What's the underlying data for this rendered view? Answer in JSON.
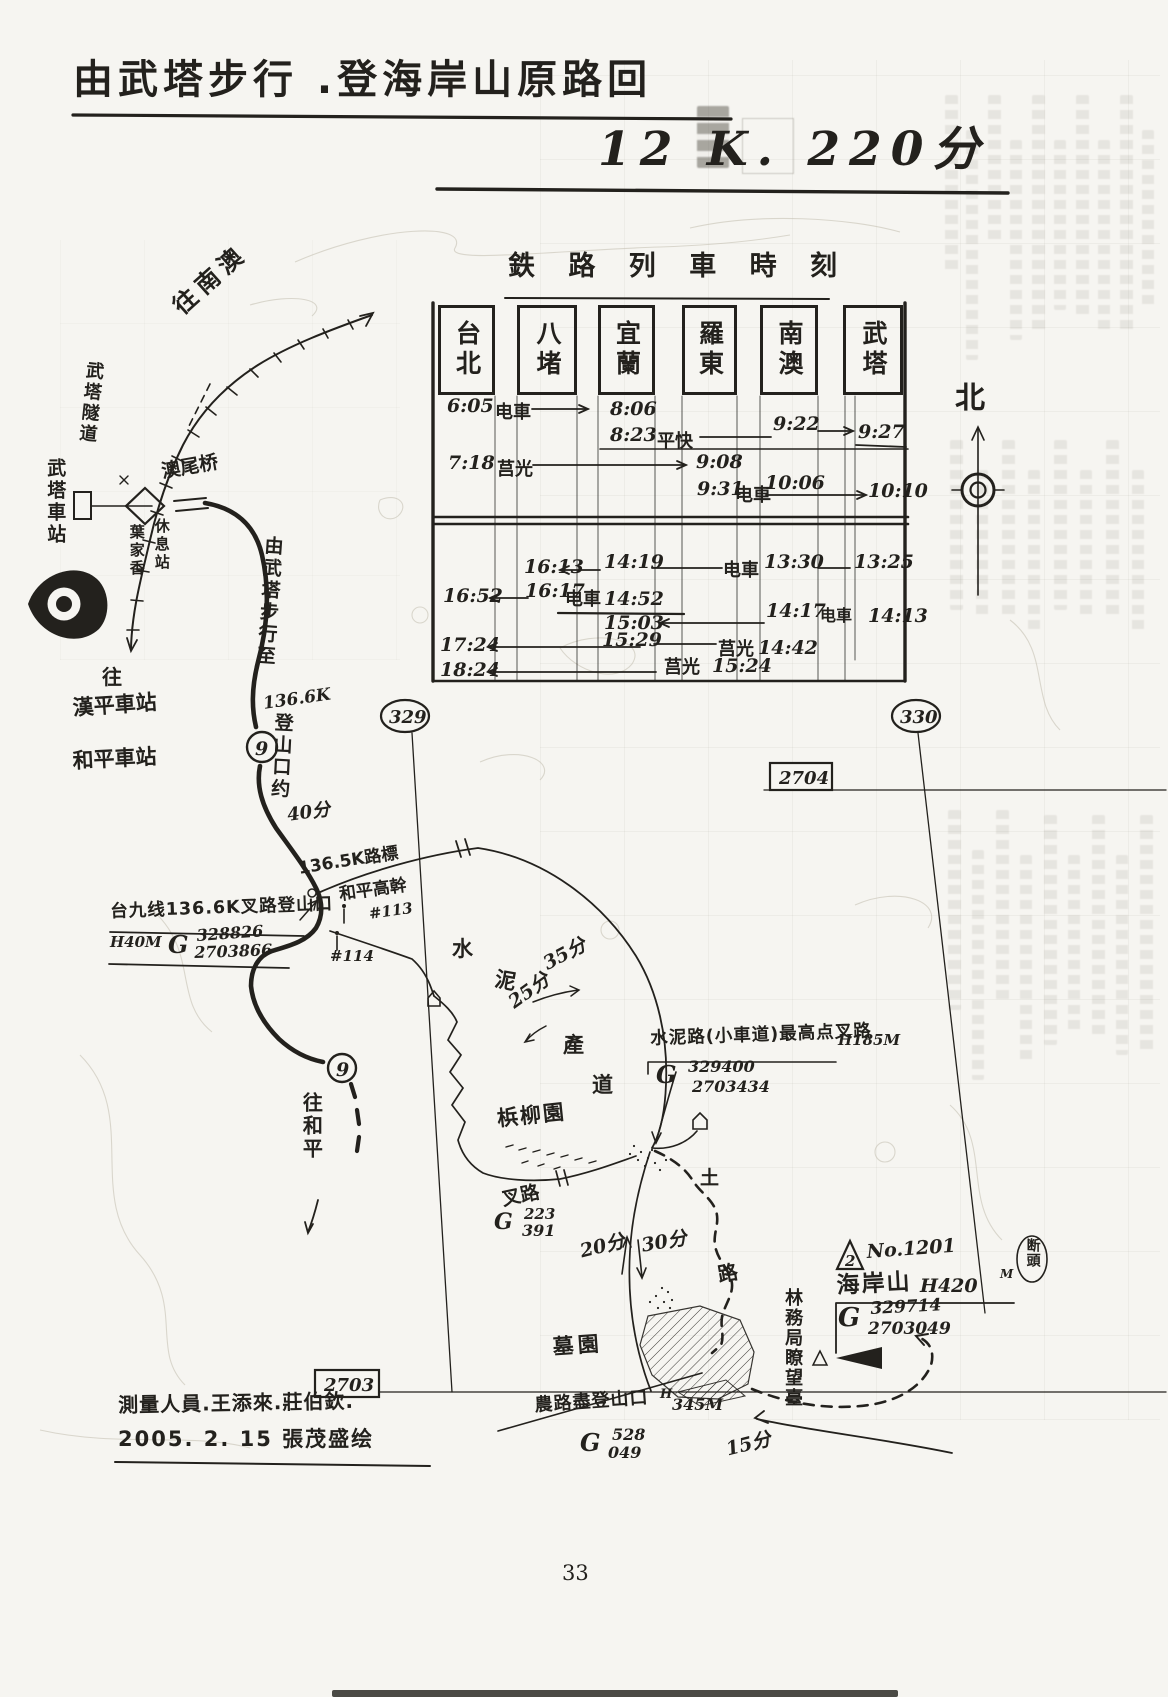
{
  "colors": {
    "ink": "#23211d",
    "paper": "#f6f5f1"
  },
  "page": {
    "number": "33"
  },
  "header": {
    "title": "由武塔步行 .登海岸山原路回",
    "subtitle_prefix": "全程约",
    "subtitle_value": "12 K. 220分"
  },
  "compass": {
    "north": "北"
  },
  "grid": {
    "v_left": "329",
    "v_right": "330",
    "h_top": "2704",
    "h_bottom": "2703"
  },
  "timetable": {
    "title": "鉄 路 列 車 時 刻",
    "stations": [
      "台北",
      "八堵",
      "宜蘭",
      "羅東",
      "南澳",
      "武塔"
    ],
    "t": {
      "r1d": "6:05",
      "r1l": "电車",
      "r1a": "8:06",
      "r2d": "8:23",
      "r2l": "平快",
      "r2a": "9:22",
      "r2b": "9:27",
      "r3d": "7:18",
      "r3l": "莒光",
      "r3a": "9:08",
      "r4d": "9:31",
      "r4l": "电車",
      "r4a": "10:06",
      "r4b": "10:10",
      "r5a": "16:13",
      "r5b": "14:19",
      "r5l": "电車",
      "r5c": "13:30",
      "r5d": "13:25",
      "r6a": "16:52",
      "r6b": "16:17",
      "r6l": "电車",
      "r6c": "14:52",
      "r7a": "15:03",
      "r7b": "14:17",
      "r7l": "电車",
      "r7c": "14:13",
      "r8a": "17:24",
      "r8b": "15:29",
      "r8l": "莒光",
      "r8c": "14:42",
      "r9a": "18:24",
      "r9l": "莒光",
      "r9b": "15:24"
    }
  },
  "map": {
    "to_nanao": "往南澳",
    "tunnel": "武塔隧道",
    "wuta_station": "武塔車站",
    "aowei_bridge": "澳尾桥",
    "rest_col_left": "葉家香",
    "rest_col_right": "休息站",
    "to_label": "往",
    "hanping_station": "漢平車站",
    "heping_station": "和平車站",
    "hwy_no": "9",
    "walk_col1": "由武塔步行至",
    "walk_k": "136.6K",
    "walk_col2": "登山口约",
    "walk_time": "40分",
    "marker_1365": "136.5K路標",
    "pole_line": "和平高幹",
    "pole_113": "#113",
    "pole_114": "#114",
    "trailhead_136": {
      "line": "台九线136.6K叉路登山口",
      "h": "H40M",
      "g": "G",
      "e": "328826",
      "n": "2703866"
    },
    "to_heping": "往和平",
    "concrete_chars": [
      "水",
      "泥",
      "產",
      "道"
    ],
    "time_35": "35分",
    "time_25": "25分",
    "highpoint": {
      "line": "水泥路(小車道)最高点叉路",
      "h": "H185M",
      "g": "G",
      "e": "329400",
      "n": "2703434"
    },
    "orchard": "梹柳園",
    "fork": {
      "label": "叉路",
      "g": "G",
      "e": "223",
      "n": "391"
    },
    "time_20": "20分",
    "time_30": "30分",
    "dirt_1": "土",
    "dirt_2": "路",
    "summit": {
      "tri_no": "2",
      "no": "No.1201",
      "badge": "断頭",
      "name": "海岸山",
      "h": "H420",
      "m": "M",
      "g": "G",
      "e": "329714",
      "n": "2703049"
    },
    "lookout": "林務局瞭望臺",
    "cemetery": "墓園",
    "farm_trailhead": {
      "line": "農路盡登山口",
      "h": "H",
      "alt": "345M",
      "g": "G",
      "e": "528",
      "n": "049"
    },
    "time_15": "15分"
  },
  "footer": {
    "surveyors": "測量人員.王添來.莊伯欽.",
    "drawn": "2005. 2. 15 張茂盛绘"
  }
}
